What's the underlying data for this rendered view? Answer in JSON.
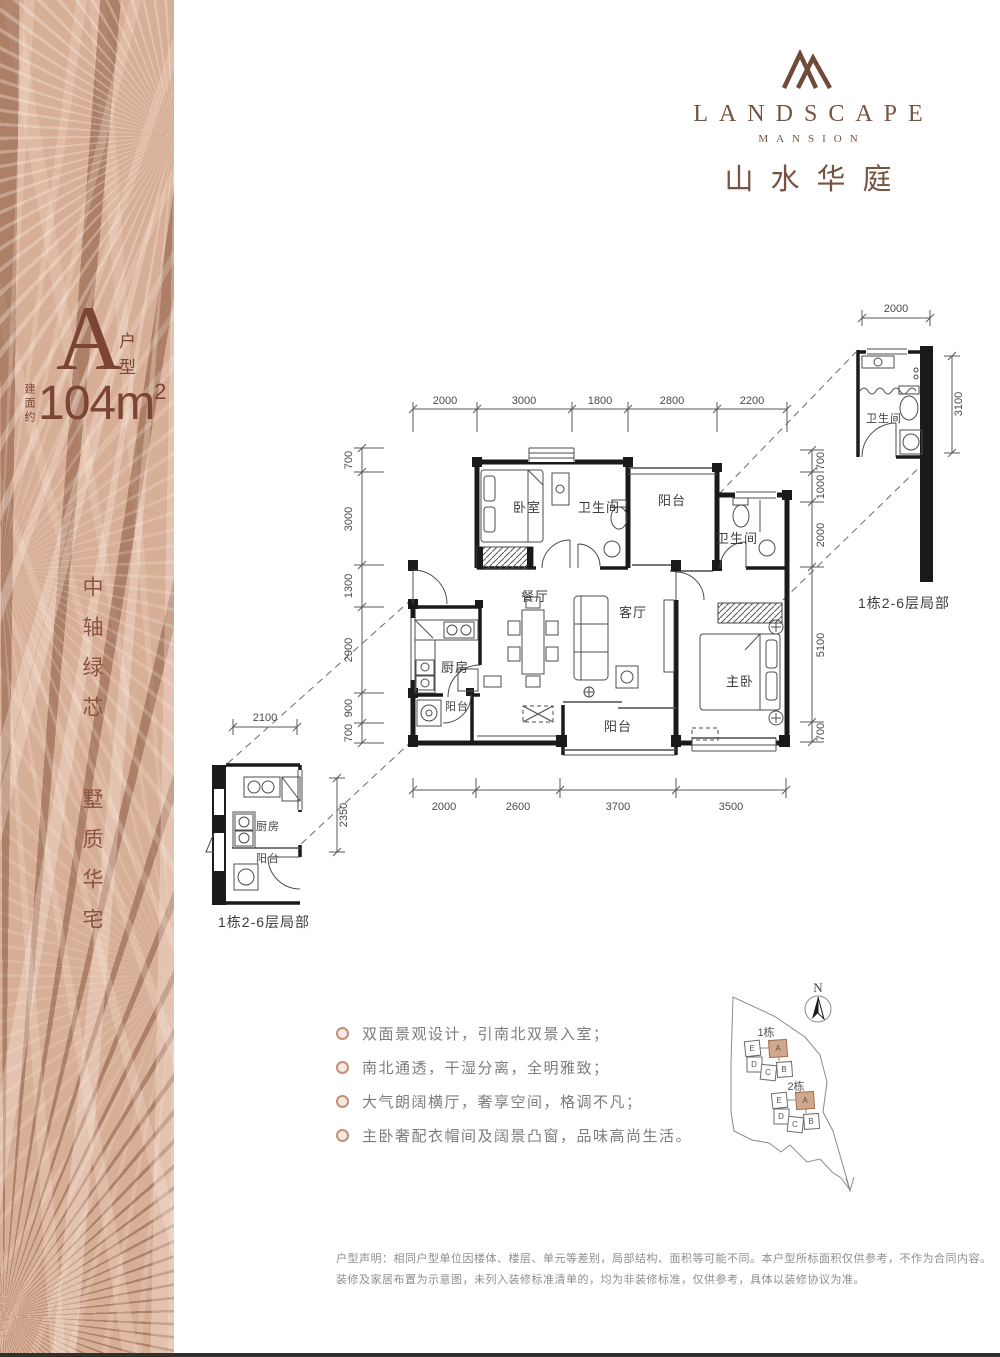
{
  "sidebar": {
    "unit_letter": "A",
    "unit_type": "户型",
    "area_prefix": "建面约",
    "area_main": "104m",
    "area_sup": "2",
    "slogan_a": "中轴绿芯",
    "slogan_b": "墅质华宅"
  },
  "logo": {
    "brand_en": "LANDSCAPE",
    "brand_sub": "MANSION",
    "brand_cn": "山水华庭"
  },
  "plan": {
    "rooms": {
      "bedroom": "卧室",
      "bath_top": "卫生间",
      "balcony_top": "阳台",
      "bath_right": "卫生间",
      "dining": "餐厅",
      "living": "客厅",
      "kitchen": "厨房",
      "balcony_left": "阳台",
      "balcony_bottom": "阳台",
      "master": "主卧"
    },
    "dims_top": [
      "2000",
      "3000",
      "1800",
      "2800",
      "2200"
    ],
    "dims_bottom": [
      "2000",
      "2600",
      "3700",
      "3500"
    ],
    "dims_left": [
      "700",
      "3000",
      "1300",
      "2900",
      "900",
      "700"
    ],
    "dims_right": [
      "700",
      "1000",
      "2000",
      "5100",
      "700"
    ]
  },
  "detail_right": {
    "dim_top": "2000",
    "dim_side": "3100",
    "room": "卫生间",
    "caption": "1栋2-6层局部"
  },
  "detail_left": {
    "dim_top": "2100",
    "dim_side": "2350",
    "room": "厨房",
    "room2": "阳台",
    "caption": "1栋2-6层局部"
  },
  "sitemap": {
    "north": "N",
    "b1": "1栋",
    "b2": "2栋",
    "c1": [
      "E",
      "D",
      "C",
      "B",
      "A"
    ],
    "c2": [
      "E",
      "D",
      "C",
      "B",
      "A"
    ]
  },
  "features": {
    "items": [
      "双面景观设计，引南北双景入室；",
      "南北通透，干湿分离，全明雅致；",
      "大气朗阔横厅，奢享空间，格调不凡；",
      "主卧奢配衣帽间及阔景凸窗，品味高尚生活。"
    ]
  },
  "disclaimer": {
    "line1": "户型声明：相同户型单位因楼体、楼层、单元等差别，局部结构、面积等可能不同。本户型所标面积仅供参考，不作为合同内容。",
    "line2": "装修及家居布置为示意图，未列入装修标准清单的，均为非装修标准，仅供参考，具体以装修协议为准。"
  }
}
